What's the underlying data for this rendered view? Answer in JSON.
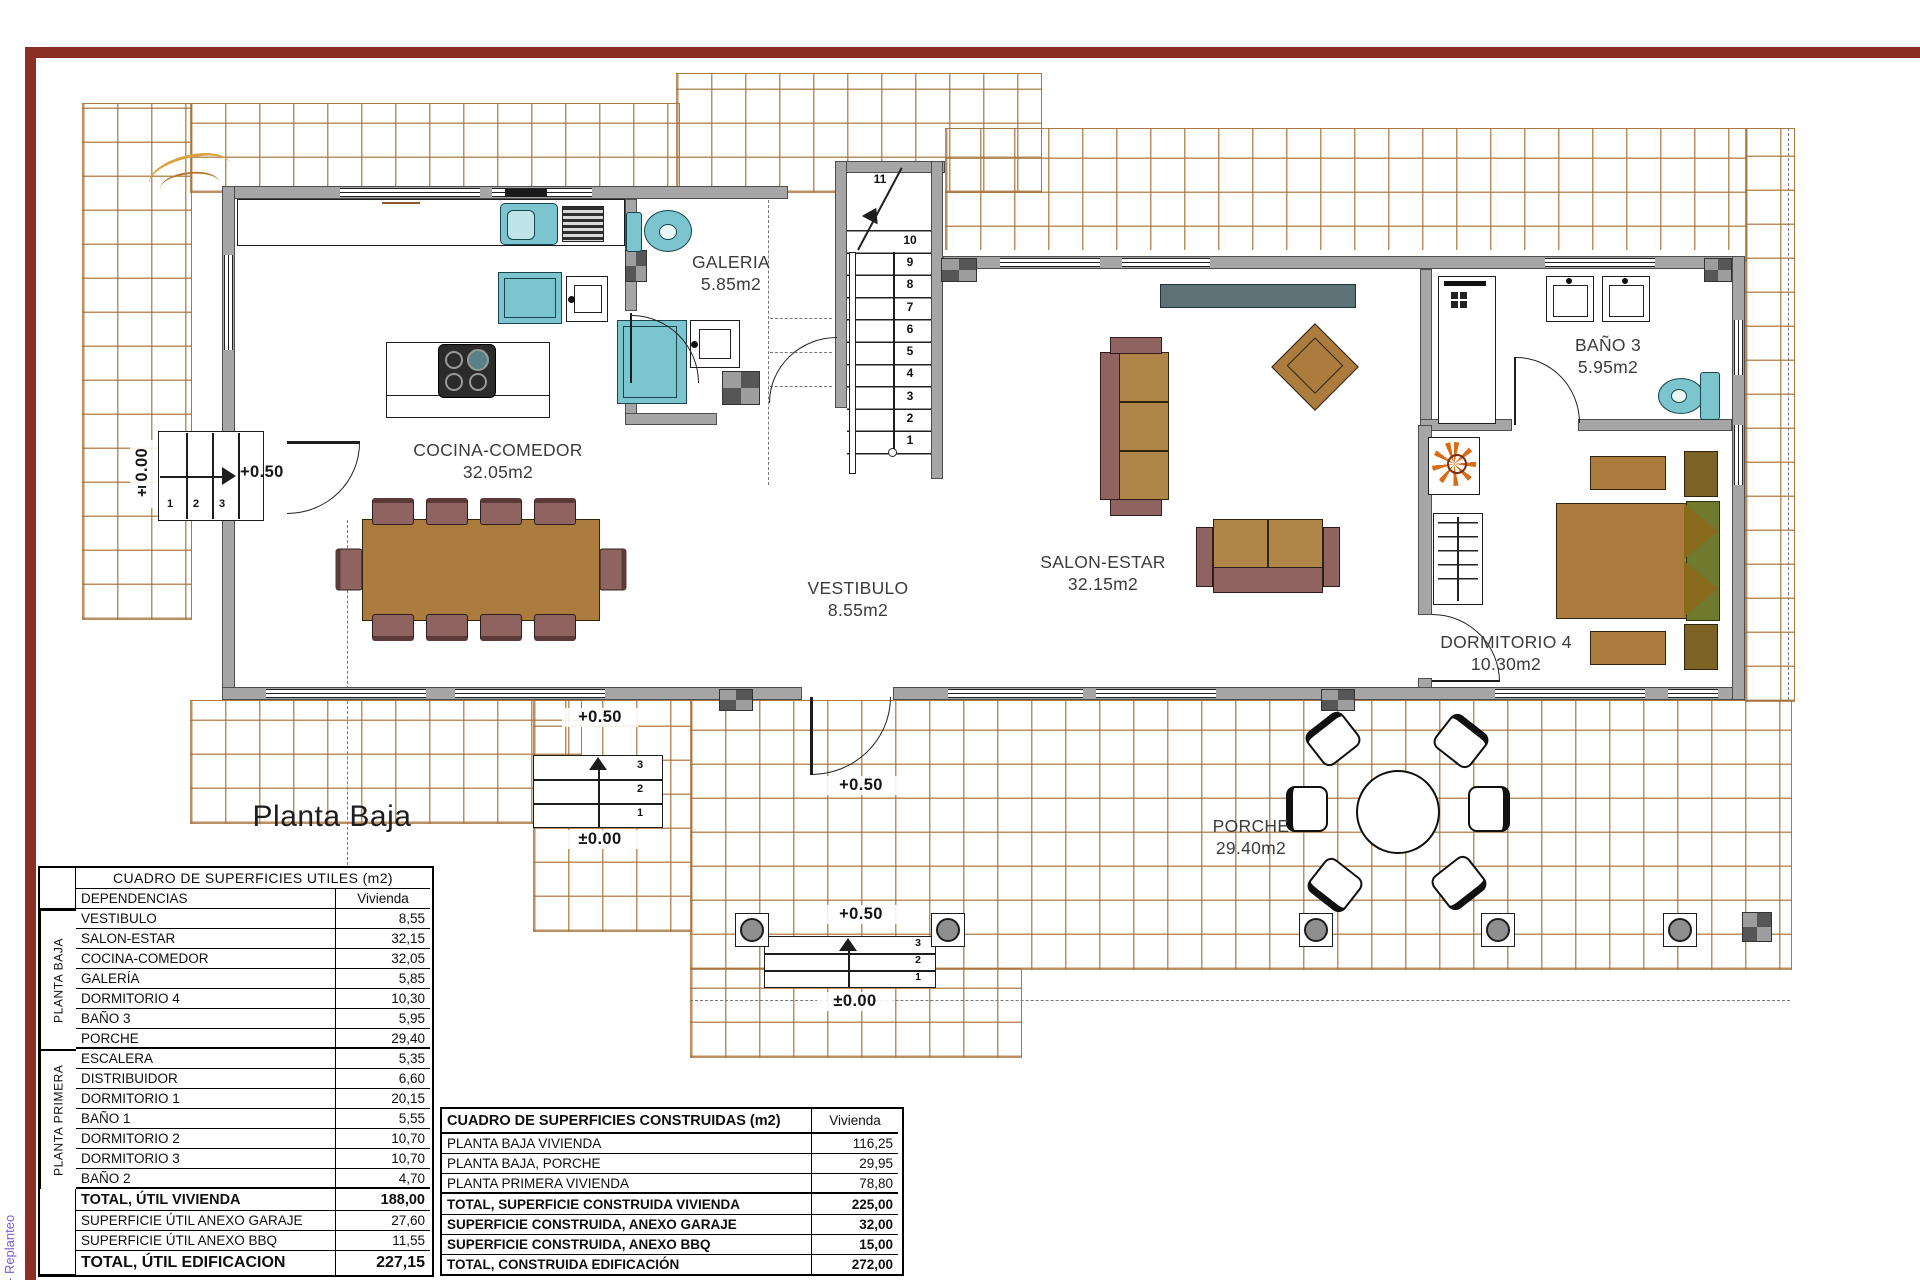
{
  "plan": {
    "title": "Planta Baja",
    "margin_note": "- Replanteo",
    "rooms": [
      {
        "name": "GALERIA",
        "area": "5.85m2"
      },
      {
        "name": "COCINA-COMEDOR",
        "area": "32.05m2"
      },
      {
        "name": "VESTIBULO",
        "area": "8.55m2"
      },
      {
        "name": "SALON-ESTAR",
        "area": "32.15m2"
      },
      {
        "name": "BAÑO 3",
        "area": "5.95m2"
      },
      {
        "name": "DORMITORIO 4",
        "area": "10.30m2"
      },
      {
        "name": "PORCHE",
        "area": "29.40m2"
      }
    ],
    "levels": {
      "upper": "+0.50",
      "ground": "±0.00"
    },
    "stairs": {
      "top_step": "11",
      "main_steps_desc": [
        "10",
        "9",
        "8",
        "7",
        "6",
        "5",
        "4",
        "3",
        "2",
        "1"
      ],
      "entry_steps": [
        "1",
        "2",
        "3"
      ],
      "exterior_steps_desc": [
        "3",
        "2",
        "1"
      ]
    },
    "colors": {
      "border_red": "#8b2e24",
      "tile_line": "#a8743c",
      "wall_gray": "#a6a6a6",
      "fixture_teal": "#7cc4ce",
      "wood_brown": "#ab7c3e",
      "upholstery_maroon": "#8e6360",
      "plant_orange": "#d96c15",
      "note_purple": "#7a5bd6"
    }
  },
  "tables": {
    "utiles": {
      "title": "CUADRO DE SUPERFICIES UTILES (m2)",
      "col_dependencias": "DEPENDENCIAS",
      "col_vivienda": "Vivienda",
      "group_baja": "PLANTA BAJA",
      "group_primera": "PLANTA PRIMERA",
      "baja": [
        {
          "label": "VESTIBULO",
          "value": "8,55"
        },
        {
          "label": "SALON-ESTAR",
          "value": "32,15"
        },
        {
          "label": "COCINA-COMEDOR",
          "value": "32,05"
        },
        {
          "label": "GALERÍA",
          "value": "5,85"
        },
        {
          "label": "DORMITORIO 4",
          "value": "10,30"
        },
        {
          "label": "BAÑO 3",
          "value": "5,95"
        },
        {
          "label": "PORCHE",
          "value": "29,40"
        }
      ],
      "primera": [
        {
          "label": "ESCALERA",
          "value": "5,35"
        },
        {
          "label": "DISTRIBUIDOR",
          "value": "6,60"
        },
        {
          "label": "DORMITORIO 1",
          "value": "20,15"
        },
        {
          "label": "BAÑO 1",
          "value": "5,55"
        },
        {
          "label": "DORMITORIO 2",
          "value": "10,70"
        },
        {
          "label": "DORMITORIO 3",
          "value": "10,70"
        },
        {
          "label": "BAÑO 2",
          "value": "4,70"
        }
      ],
      "totals": [
        {
          "label": "TOTAL, ÚTIL VIVIENDA",
          "value": "188,00"
        },
        {
          "label": "SUPERFICIE ÚTIL ANEXO GARAJE",
          "value": "27,60"
        },
        {
          "label": "SUPERFICIE ÚTIL ANEXO BBQ",
          "value": "11,55"
        },
        {
          "label": "TOTAL, ÚTIL EDIFICACION",
          "value": "227,15"
        }
      ]
    },
    "construidas": {
      "title": "CUADRO DE SUPERFICIES CONSTRUIDAS (m2)",
      "col_vivienda": "Vivienda",
      "rows": [
        {
          "label": "PLANTA BAJA VIVIENDA",
          "value": "116,25"
        },
        {
          "label": "PLANTA BAJA, PORCHE",
          "value": "29,95"
        },
        {
          "label": "PLANTA PRIMERA VIVIENDA",
          "value": "78,80"
        }
      ],
      "totals": [
        {
          "label": "TOTAL, SUPERFICIE CONSTRUIDA VIVIENDA",
          "value": "225,00"
        },
        {
          "label": "SUPERFICIE CONSTRUIDA, ANEXO GARAJE",
          "value": "32,00"
        },
        {
          "label": "SUPERFICIE CONSTRUIDA, ANEXO BBQ",
          "value": "15,00"
        },
        {
          "label": "TOTAL, CONSTRUIDA EDIFICACIÓN",
          "value": "272,00"
        }
      ]
    }
  }
}
